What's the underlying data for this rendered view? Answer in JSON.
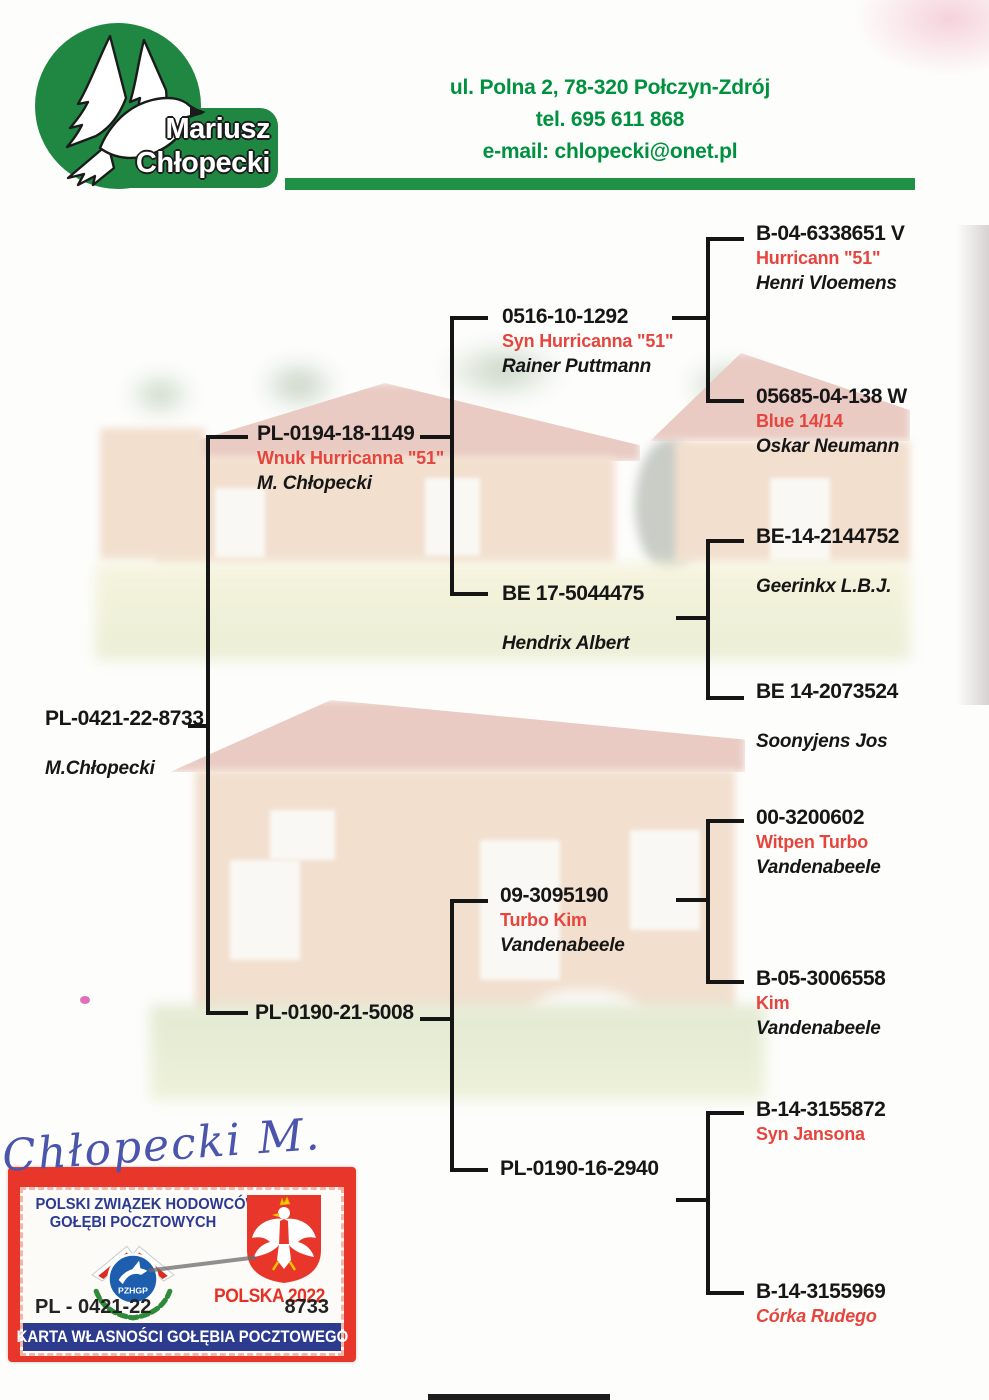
{
  "header": {
    "logo": {
      "name_line1": "Mariusz",
      "name_line2": "Chłopecki"
    },
    "contact": {
      "address": "ul. Polna 2, 78-320 Połczyn-Zdrój",
      "phone": "tel. 695 611 868",
      "email": "e-mail: chlopecki@onet.pl"
    }
  },
  "pedigree": {
    "subject": {
      "ring": "PL-0421-22-8733",
      "nickname": "",
      "owner": "M.Chłopecki"
    },
    "parents": [
      {
        "ring": "PL-0194-18-1149",
        "nickname": "Wnuk Hurricanna \"51\"",
        "owner": "M. Chłopecki"
      },
      {
        "ring": "PL-0190-21-5008",
        "nickname": "",
        "owner": ""
      }
    ],
    "grandparents": [
      {
        "ring": "0516-10-1292",
        "nickname": "Syn Hurricanna \"51\"",
        "owner": "Rainer Puttmann"
      },
      {
        "ring": "BE 17-5044475",
        "nickname": "",
        "owner": "Hendrix Albert"
      },
      {
        "ring": "09-3095190",
        "nickname": "Turbo Kim",
        "owner": "Vandenabeele"
      },
      {
        "ring": "PL-0190-16-2940",
        "nickname": "",
        "owner": ""
      }
    ],
    "great_grandparents": [
      {
        "ring": "B-04-6338651 V",
        "nickname": "Hurricann \"51\"",
        "owner": "Henri Vloemens"
      },
      {
        "ring": "05685-04-138 W",
        "nickname": "Blue 14/14",
        "owner": "Oskar Neumann"
      },
      {
        "ring": "BE-14-2144752",
        "nickname": "",
        "owner": "Geerinkx L.B.J."
      },
      {
        "ring": "BE 14-2073524",
        "nickname": "",
        "owner": "Soonyjens Jos"
      },
      {
        "ring": "00-3200602",
        "nickname": "Witpen Turbo",
        "owner": "Vandenabeele"
      },
      {
        "ring": "B-05-3006558",
        "nickname": "Kim",
        "owner": "Vandenabeele"
      },
      {
        "ring": "B-14-3155872",
        "nickname": "Syn Jansona",
        "owner": ""
      },
      {
        "ring": "B-14-3155969",
        "nickname": "Córka Rudego",
        "owner": ""
      }
    ]
  },
  "signature": {
    "text": "Chłopecki M."
  },
  "ownership_card": {
    "org_line1": "POLSKI ZWIĄZEK HODOWCÓW",
    "org_line2": "GOŁĘBI POCZTOWYCH",
    "emblem_text": "PZHGP",
    "year_label": "POLSKA 2022",
    "ring_prefix": "PL - 0421-22",
    "ring_serial": "8733",
    "title": "KARTA WŁASNOŚCI GOŁĘBIA POCZTOWEGO"
  },
  "colors": {
    "brand_green": "#1f8742",
    "contact_green": "#00913f",
    "nickname_red": "#e6453e",
    "card_red": "#e8372a",
    "card_blue": "#2d3b8f",
    "line_black": "#151515",
    "signature_ink": "#4a55ab"
  }
}
